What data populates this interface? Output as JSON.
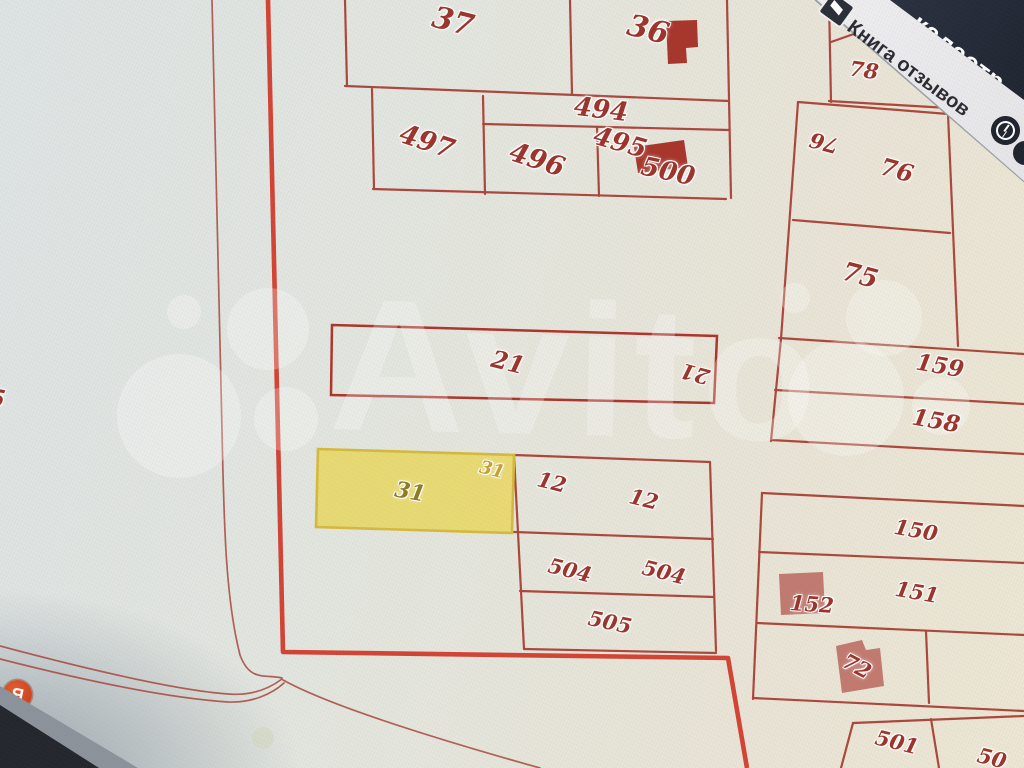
{
  "top_banner": {
    "navy_text": "кадастр",
    "bookmark_label": "Книга отзывов",
    "icons": {
      "bookmark": "book-icon",
      "history": "clock-icon",
      "edge": "partial-circle-icon"
    }
  },
  "brand_watermark": {
    "text": "Avito"
  },
  "map_badge": {
    "yandex_label": "Я"
  },
  "map": {
    "selected_parcel": "31",
    "selected_fill": "#e9d75c",
    "boundary_color": "#d23a2b",
    "line_color": "#a73a30",
    "label_color": "#9c342b",
    "parcel_labels": [
      {
        "t": "37",
        "x": 453,
        "y": 22,
        "r": 14,
        "s": 30
      },
      {
        "t": "36",
        "x": 648,
        "y": 30,
        "r": 14,
        "s": 30
      },
      {
        "t": "494",
        "x": 601,
        "y": 110,
        "r": 7,
        "s": 26
      },
      {
        "t": "497",
        "x": 427,
        "y": 142,
        "r": 18,
        "s": 27
      },
      {
        "t": "496",
        "x": 537,
        "y": 160,
        "r": 18,
        "s": 27
      },
      {
        "t": "495",
        "x": 620,
        "y": 143,
        "r": 16,
        "s": 26
      },
      {
        "t": "500",
        "x": 668,
        "y": 172,
        "r": 12,
        "s": 26
      },
      {
        "t": "78",
        "x": 864,
        "y": 70,
        "r": 8,
        "s": 21
      },
      {
        "t": "76",
        "x": 824,
        "y": 143,
        "r": 195,
        "s": 21
      },
      {
        "t": "76",
        "x": 897,
        "y": 170,
        "r": 15,
        "s": 24
      },
      {
        "t": "75",
        "x": 860,
        "y": 276,
        "r": 15,
        "s": 26
      },
      {
        "t": "159",
        "x": 940,
        "y": 366,
        "r": 10,
        "s": 23
      },
      {
        "t": "158",
        "x": 936,
        "y": 421,
        "r": 10,
        "s": 23
      },
      {
        "t": "21",
        "x": 508,
        "y": 362,
        "r": 14,
        "s": 24
      },
      {
        "t": "21",
        "x": 695,
        "y": 374,
        "r": 195,
        "s": 21
      },
      {
        "t": "31",
        "x": 410,
        "y": 492,
        "r": 10,
        "s": 22,
        "c": "#8d7b25"
      },
      {
        "t": "31",
        "x": 492,
        "y": 470,
        "r": 14,
        "s": 18,
        "c": "#c9a02e"
      },
      {
        "t": "12",
        "x": 552,
        "y": 482,
        "r": 14,
        "s": 21
      },
      {
        "t": "12",
        "x": 644,
        "y": 499,
        "r": 14,
        "s": 21
      },
      {
        "t": "504",
        "x": 570,
        "y": 570,
        "r": 14,
        "s": 21
      },
      {
        "t": "504",
        "x": 664,
        "y": 572,
        "r": 14,
        "s": 21
      },
      {
        "t": "505",
        "x": 610,
        "y": 622,
        "r": 12,
        "s": 21
      },
      {
        "t": "150",
        "x": 916,
        "y": 530,
        "r": 10,
        "s": 21
      },
      {
        "t": "151",
        "x": 917,
        "y": 592,
        "r": 10,
        "s": 21
      },
      {
        "t": "152",
        "x": 812,
        "y": 604,
        "r": 4,
        "s": 21
      },
      {
        "t": "72",
        "x": 857,
        "y": 666,
        "r": 28,
        "s": 21
      },
      {
        "t": "501",
        "x": 897,
        "y": 742,
        "r": 14,
        "s": 21
      },
      {
        "t": "50",
        "x": 992,
        "y": 758,
        "r": 14,
        "s": 21
      },
      {
        "t": "5",
        "x": -3,
        "y": 398,
        "r": 10,
        "s": 24
      }
    ]
  }
}
